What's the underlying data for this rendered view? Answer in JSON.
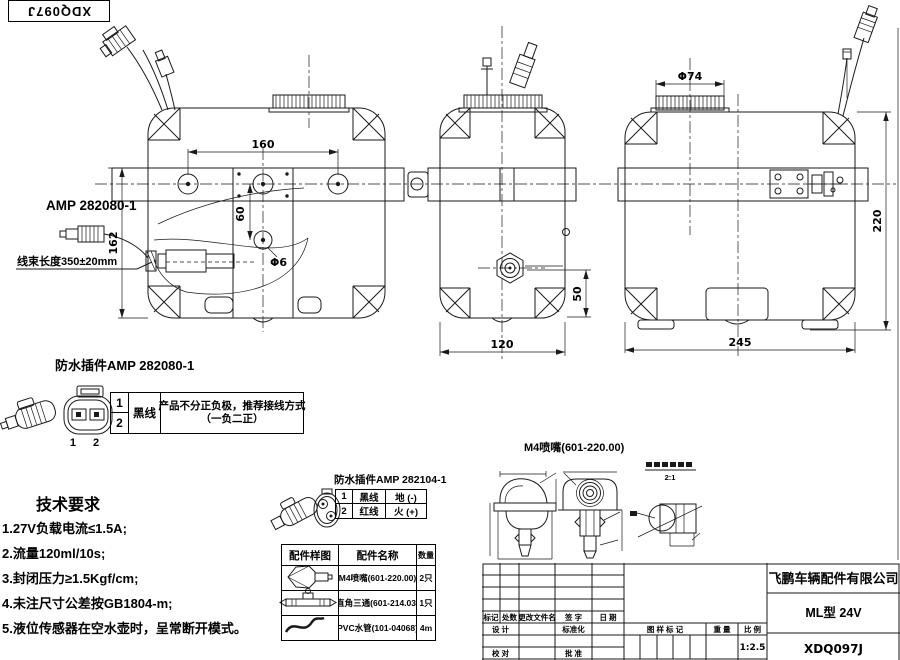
{
  "sheet": {
    "corner_code": "XDQ097J"
  },
  "front_view": {
    "amp_label": "AMP 282080-1",
    "harness_label": "线束长度350±20mm",
    "dim_hole_span": "160",
    "dim_hole_offset": "60",
    "dim_hole_dia": "Φ6",
    "dim_height": "162"
  },
  "side_view": {
    "dim_width": "120",
    "dim_fitting": "50"
  },
  "rear_view": {
    "dim_cap_dia": "Φ74",
    "dim_height": "220",
    "dim_width": "245"
  },
  "plug1": {
    "title": "防水插件AMP 282080-1",
    "pins": "1 2",
    "row1_no": "1",
    "row2_no": "2",
    "wire": "黑线",
    "note_line1": "产品不分正负极，推荐接线方式",
    "note_line2": "（一负二正）"
  },
  "tech": {
    "title": "技术要求",
    "items": [
      "1.27V负载电流≤1.5A;",
      "2.流量120ml/10s;",
      "3.封闭压力≥1.5Kgf/cm;",
      "4.未注尺寸公差按GB1804-m;",
      "5.液位传感器在空水壶时，呈常断开模式。"
    ]
  },
  "plug2": {
    "title": "防水插件AMP 282104-1",
    "rows": [
      {
        "no": "1",
        "wire": "黑线",
        "pol": "地 (-)"
      },
      {
        "no": "2",
        "wire": "红线",
        "pol": "火 (+)"
      }
    ]
  },
  "parts": {
    "headers": [
      "配件样图",
      "配件名称",
      "数量"
    ],
    "rows": [
      {
        "name": "M4喷嘴(601-220.00)",
        "qty": "2只"
      },
      {
        "name": "直角三通(601-214.03)",
        "qty": "1只"
      },
      {
        "name": "PVC水管(101-04068)",
        "qty": "4m"
      }
    ]
  },
  "nozzle": {
    "title": "M4喷嘴(601-220.00)",
    "scale": "2:1"
  },
  "title_block": {
    "rev_headers": [
      "标记",
      "处数",
      "更改文件名",
      "签 字",
      "日 期"
    ],
    "design_label": "设 计",
    "standard_label": "标准化",
    "check_label": "校 对",
    "approve_label": "批 准",
    "stamp_label": "图 样 标 记",
    "weight_label": "重 量",
    "scale_label": "比 例",
    "scale_value": "1:2.5",
    "company": "飞鹏车辆配件有限公司",
    "model": "ML型 24V",
    "drawing_no": "XDQ097J"
  }
}
